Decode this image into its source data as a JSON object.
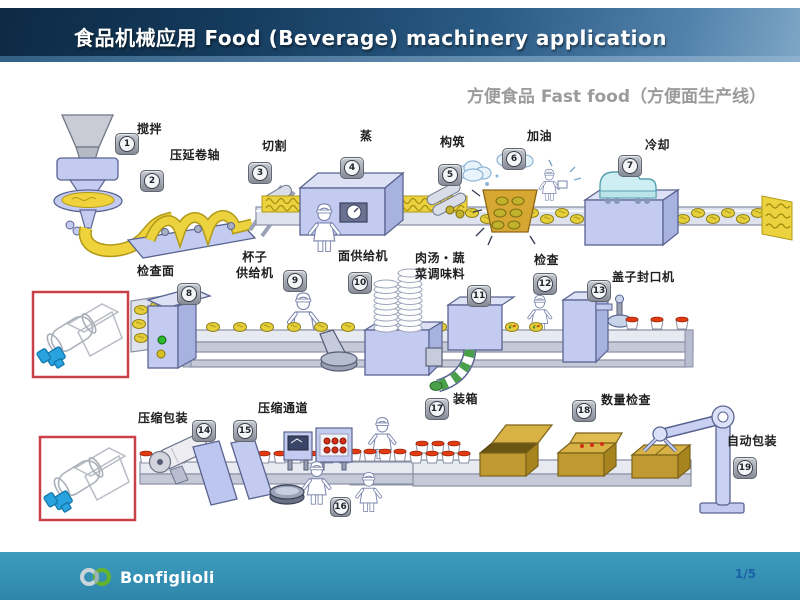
{
  "header": {
    "title": "食品机械应用  Food (Beverage) machinery application"
  },
  "subtitle": "方便食品 Fast food（方便面生产线）",
  "steps": [
    {
      "num": "1",
      "label": "搅拌"
    },
    {
      "num": "2",
      "label": "压延卷轴"
    },
    {
      "num": "3",
      "label": "切割"
    },
    {
      "num": "4",
      "label": "蒸"
    },
    {
      "num": "5",
      "label": "构筑"
    },
    {
      "num": "6",
      "label": "加油"
    },
    {
      "num": "7",
      "label": "冷却"
    },
    {
      "num": "8",
      "label": "检查面"
    },
    {
      "num": "9",
      "label": "杯子\n供给机"
    },
    {
      "num": "10",
      "label": "面供给机"
    },
    {
      "num": "11",
      "label": "肉汤・蔬\n菜调味料"
    },
    {
      "num": "12",
      "label": "检查"
    },
    {
      "num": "13",
      "label": "盖子封口机"
    },
    {
      "num": "14",
      "label": "压缩包装"
    },
    {
      "num": "15",
      "label": "压缩通道"
    },
    {
      "num": "16",
      "label": ""
    },
    {
      "num": "17",
      "label": "装箱"
    },
    {
      "num": "18",
      "label": "数量检查"
    },
    {
      "num": "19",
      "label": "自动包装"
    }
  ],
  "footer": {
    "logo_text": "Bonfiglioli",
    "page": "1/5"
  },
  "colors": {
    "header_dark": "#0d2a44",
    "header_light": "#7ea6c6",
    "footer_teal": "#3595b9",
    "highlight_red": "#c94048",
    "machine_blue": "#c3cbf0",
    "noodle_yellow": "#ecd23e",
    "lid_red": "#e23b12",
    "box_gold": "#d2ac3e",
    "logo_green": "#63b32e",
    "motor_blue": "#29a3e0"
  }
}
